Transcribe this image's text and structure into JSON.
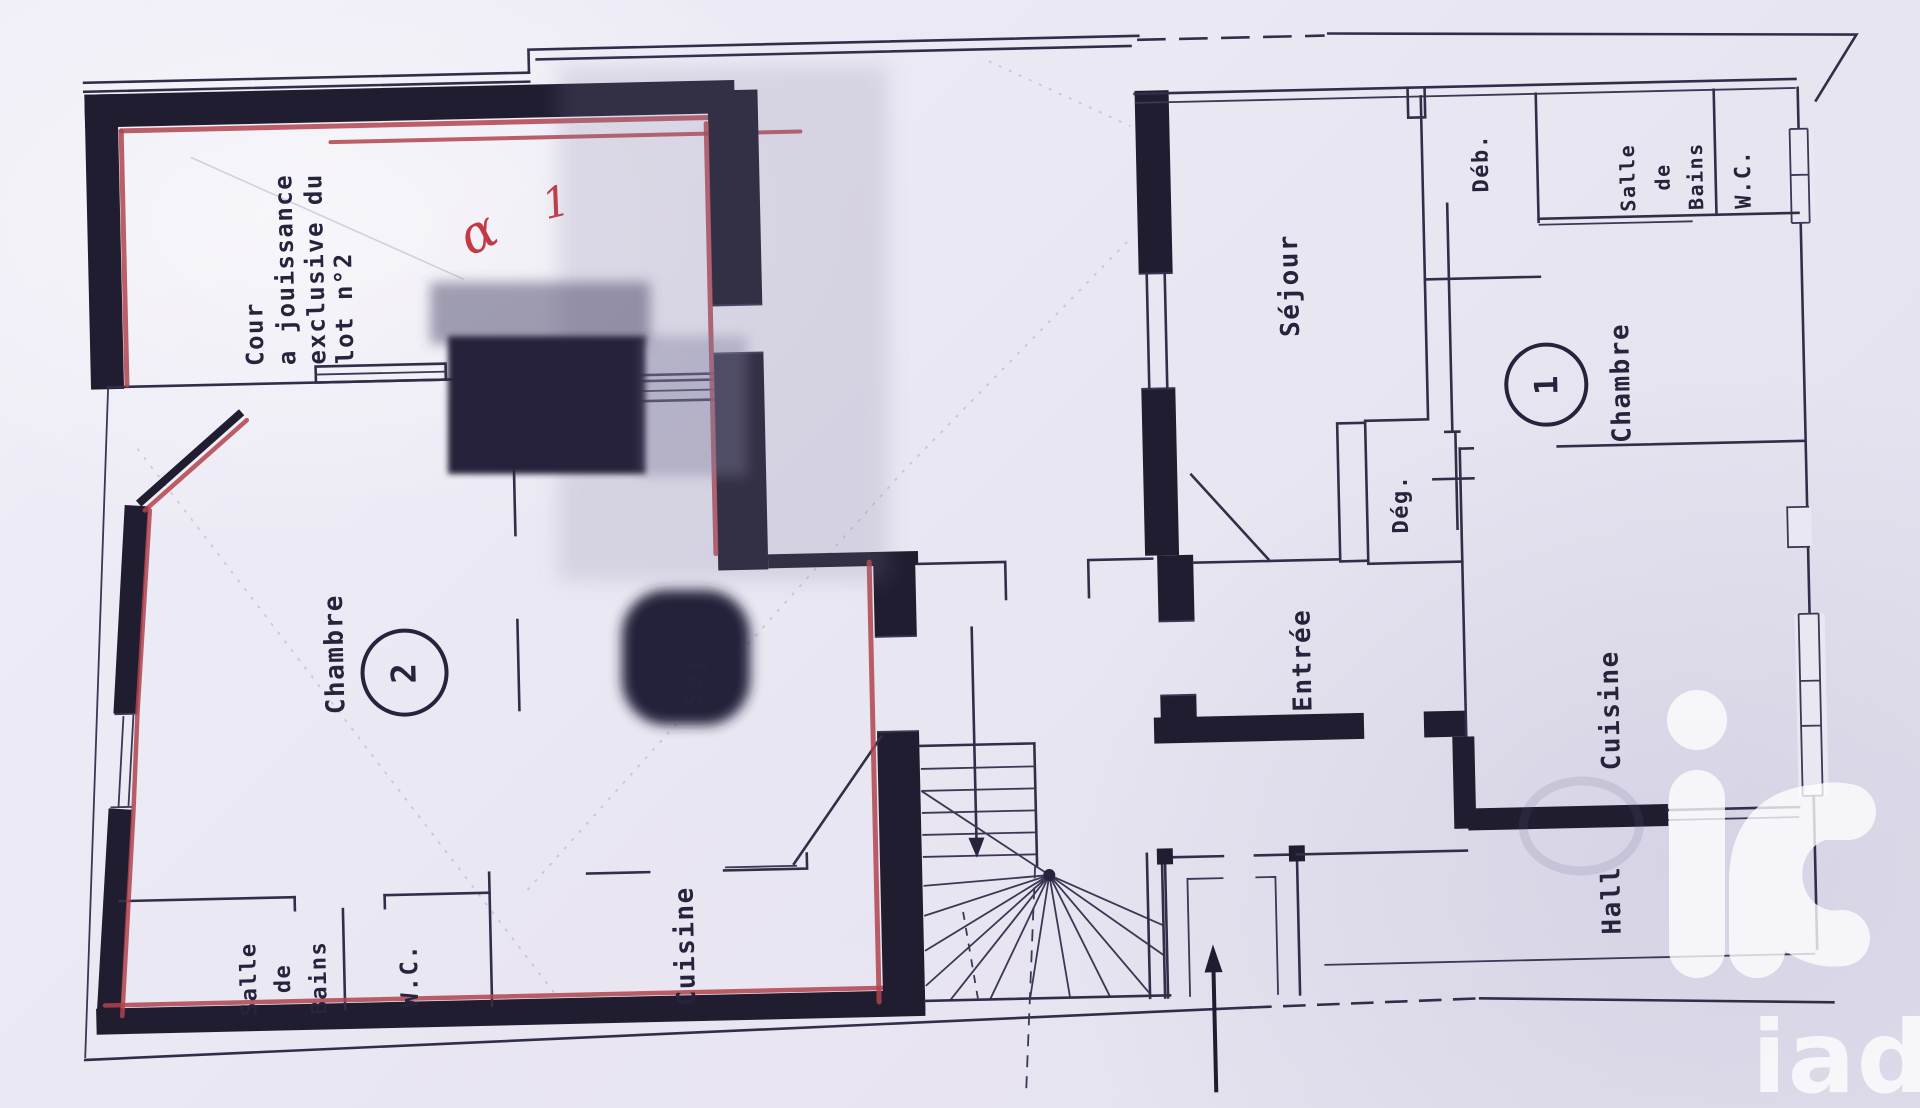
{
  "colors": {
    "paper": "#e9e7f2",
    "ink_wall": "#201d30",
    "ink_thin": "#322e49",
    "red_highlight": "#b2434e",
    "redaction": "#25213a",
    "watermark": "#ffffff"
  },
  "lot2": {
    "courtyard": {
      "lines": [
        "Cour",
        "a jouissance",
        "exclusive du",
        "lot n°2"
      ]
    },
    "rooms": {
      "chambre": {
        "name": "Chambre",
        "number": "2"
      },
      "salle_de_bains": [
        "Salle",
        "de",
        "Bains"
      ],
      "wc": "W.C.",
      "cuisine": "Cuisine",
      "sejour_fragment": "Séj"
    },
    "annotations": {
      "scribble": "α",
      "number": "1"
    }
  },
  "lot1": {
    "rooms": {
      "sejour": "Séjour",
      "deb": "Déb.",
      "salle_de_bains": [
        "Salle",
        "de",
        "Bains"
      ],
      "wc": "W.C.",
      "chambre": {
        "name": "Chambre",
        "number": "1"
      },
      "deg": "Dég.",
      "entree": "Entrée",
      "cuisine": "Cuisine",
      "hall": "Hall"
    }
  },
  "watermark": {
    "brand": "iad"
  }
}
